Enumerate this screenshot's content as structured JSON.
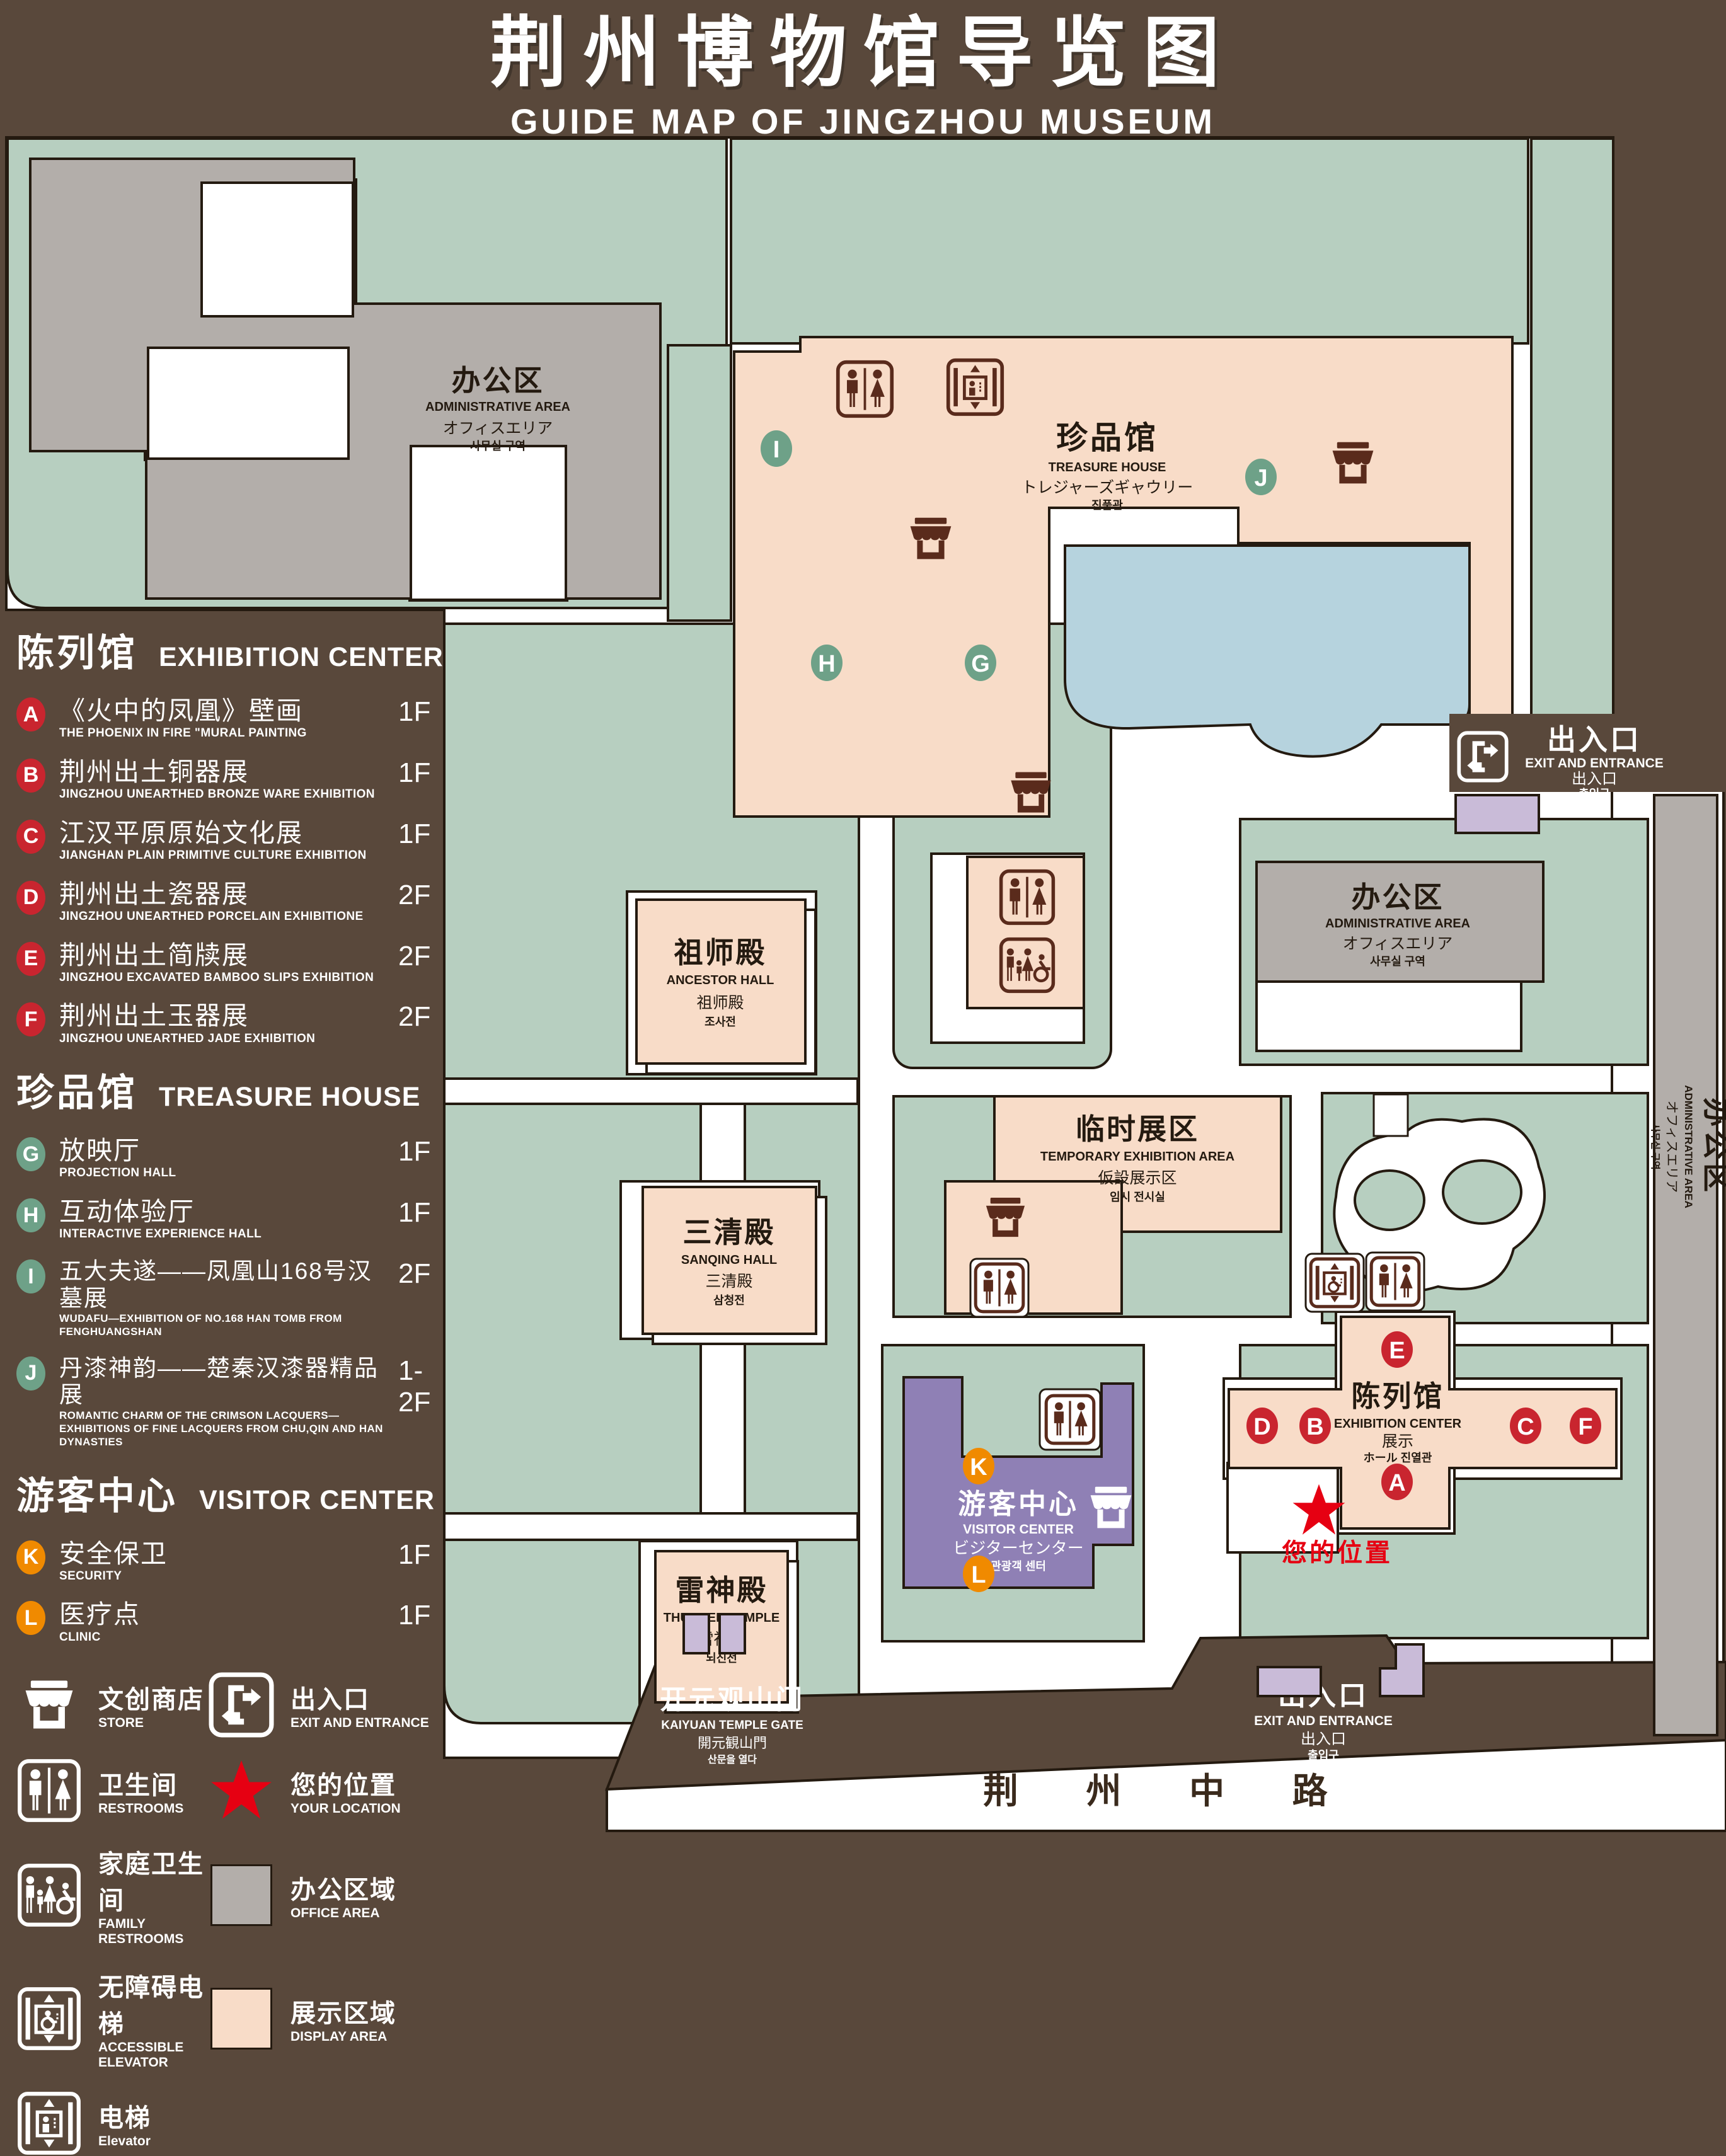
{
  "title": {
    "zh": "荆州博物馆导览图",
    "en": "GUIDE MAP OF JINGZHOU MUSEUM"
  },
  "legend": {
    "sections": [
      {
        "zh": "陈列馆",
        "en": "EXHIBITION CENTER",
        "items": [
          {
            "letter": "A",
            "zh": "《火中的凤凰》壁画",
            "en": "THE PHOENIX IN FIRE \"MURAL PAINTING",
            "floor": "1F"
          },
          {
            "letter": "B",
            "zh": "荆州出土铜器展",
            "en": "JINGZHOU UNEARTHED BRONZE WARE EXHIBITION",
            "floor": "1F"
          },
          {
            "letter": "C",
            "zh": "江汉平原原始文化展",
            "en": "JIANGHAN PLAIN PRIMITIVE CULTURE EXHIBITION",
            "floor": "1F"
          },
          {
            "letter": "D",
            "zh": "荆州出土瓷器展",
            "en": "JINGZHOU UNEARTHED PORCELAIN EXHIBITIONE",
            "floor": "2F"
          },
          {
            "letter": "E",
            "zh": "荆州出土简牍展",
            "en": "JINGZHOU EXCAVATED BAMBOO SLIPS EXHIBITION",
            "floor": "2F"
          },
          {
            "letter": "F",
            "zh": "荆州出土玉器展",
            "en": "JINGZHOU UNEARTHED JADE EXHIBITION",
            "floor": "2F"
          }
        ]
      },
      {
        "zh": "珍品馆",
        "en": "TREASURE HOUSE",
        "items": [
          {
            "letter": "G",
            "zh": "放映厅",
            "en": "PROJECTION HALL",
            "floor": "1F"
          },
          {
            "letter": "H",
            "zh": "互动体验厅",
            "en": "INTERACTIVE EXPERIENCE HALL",
            "floor": "1F"
          },
          {
            "letter": "I",
            "zh": "五大夫遂——凤凰山168号汉墓展",
            "en": "WUDAFU—EXHIBITION OF NO.168 HAN TOMB FROM FENGHUANGSHAN",
            "floor": "2F"
          },
          {
            "letter": "J",
            "zh": "丹漆神韵——楚秦汉漆器精品展",
            "en": "ROMANTIC CHARM OF THE CRIMSON LACQUERS—EXHIBITIONS OF FINE LACQUERS FROM CHU,QIN AND HAN DYNASTIES",
            "floor": "1-2F"
          }
        ]
      },
      {
        "zh": "游客中心",
        "en": "VISITOR CENTER",
        "items": [
          {
            "letter": "K",
            "zh": "安全保卫",
            "en": "SECURITY",
            "floor": "1F"
          },
          {
            "letter": "L",
            "zh": "医疗点",
            "en": "CLINIC",
            "floor": "1F"
          }
        ]
      }
    ],
    "symbols": [
      {
        "zh": "文创商店",
        "en": "STORE"
      },
      {
        "zh": "卫生间",
        "en": "RESTROOMS"
      },
      {
        "zh": "家庭卫生间",
        "en": "FAMILY RESTROOMS"
      },
      {
        "zh": "无障碍电梯",
        "en": "ACCESSIBLE ELEVATOR"
      },
      {
        "zh": "电梯",
        "en": "Elevator"
      },
      {
        "zh": "出入口",
        "en": "EXIT AND ENTRANCE"
      },
      {
        "zh": "您的位置",
        "en": "YOUR LOCATION"
      },
      {
        "zh": "办公区域",
        "en": "OFFICE AREA"
      },
      {
        "zh": "展示区域",
        "en": "DISPLAY AREA"
      }
    ]
  },
  "map": {
    "buildings": {
      "admin_top": {
        "zh": "办公区",
        "en": "ADMINISTRATIVE AREA",
        "jp": "オフィスエリア",
        "kr": "사무실 구역"
      },
      "treasure": {
        "zh": "珍品馆",
        "en": "TREASURE HOUSE",
        "jp": "トレジャーズギャウリー",
        "kr": "진품관"
      },
      "ancestor": {
        "zh": "祖师殿",
        "en": "ANCESTOR HALL",
        "zh2": "祖师殿",
        "kr": "조사전"
      },
      "admin_mid": {
        "zh": "办公区",
        "en": "ADMINISTRATIVE AREA",
        "jp": "オフィスエリア",
        "kr": "사무실 구역"
      },
      "temporary": {
        "zh": "临时展区",
        "en": "TEMPORARY EXHIBITION AREA",
        "jp": "仮設展示区",
        "kr": "임시 전시실"
      },
      "sanqing": {
        "zh": "三清殿",
        "en": "SANQING HALL",
        "zh2": "三清殿",
        "kr": "삼청전"
      },
      "thunder": {
        "zh": "雷神殿",
        "en": "THUNDER TEMPLE",
        "zh2": "雷神殿",
        "kr": "뇌신전"
      },
      "visitor": {
        "zh": "游客中心",
        "en": "VISITOR CENTER",
        "jp": "ビジターセンター",
        "kr": "관광객 센터"
      },
      "exhibition": {
        "zh": "陈列馆",
        "en": "EXHIBITION CENTER",
        "zh2": "展示",
        "jkr": "ホール 진열관"
      },
      "admin_right": {
        "zh": "办公区",
        "en": "ADMINISTRATIVE AREA",
        "jp": "オフィスエリア",
        "kr": "사무실 구역"
      },
      "gate": {
        "zh": "开元观山门",
        "en": "KAIYUAN TEMPLE GATE",
        "jp": "開元観山門",
        "kr": "산문을 열다"
      },
      "exit_right": {
        "zh": "出入口",
        "en": "EXIT AND ENTRANCE",
        "zh2": "出入口",
        "kr": "출입구"
      },
      "exit_bottom": {
        "zh": "出入口",
        "en": "EXIT AND ENTRANCE",
        "zh2": "出入口",
        "kr": "출입구"
      },
      "road": {
        "zh": "荆 州 中 路"
      }
    },
    "markers": {
      "A": "A",
      "B": "B",
      "C": "C",
      "D": "D",
      "E": "E",
      "F": "F",
      "G": "G",
      "H": "H",
      "I": "I",
      "J": "J",
      "K": "K",
      "L": "L"
    },
    "your_location": "您的位置"
  }
}
